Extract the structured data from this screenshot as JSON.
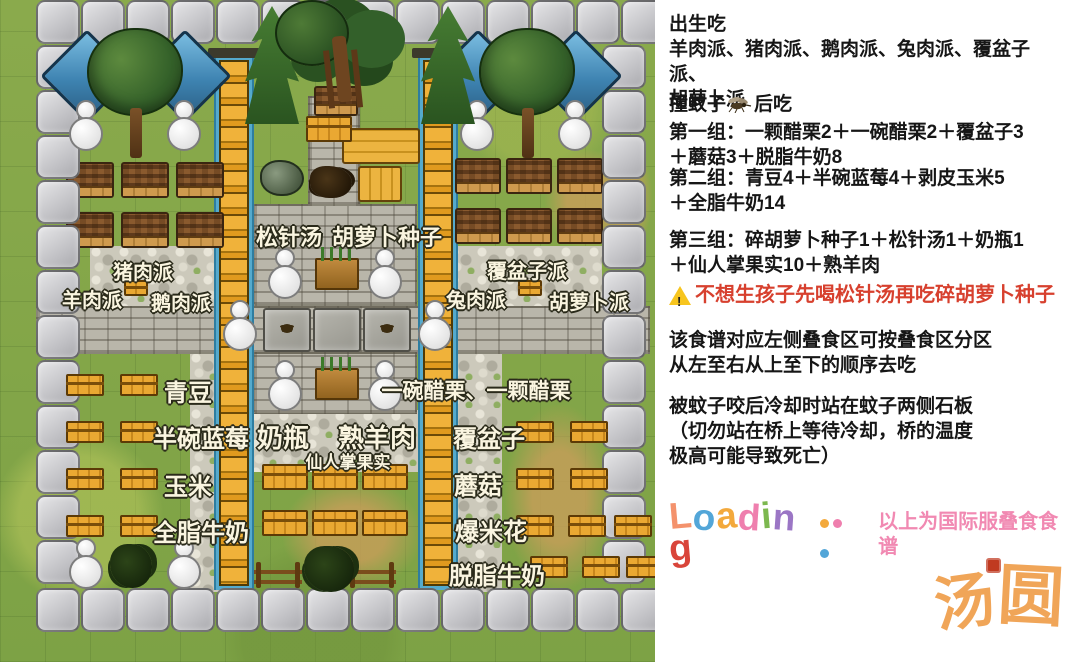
{
  "right_panel": {
    "birth": {
      "title": "出生吃",
      "body": "羊肉派、猪肉派、鹅肉派、兔肉派、覆盆子派、\n胡萝卜派"
    },
    "mosquito": {
      "title_pre": "撞蚊子",
      "title_post": "后吃",
      "group1": "第一组：一颗醋栗2＋一碗醋栗2＋覆盆子3\n＋蘑菇3＋脱脂牛奶8"
    },
    "group2": "第二组：青豆4＋半碗蓝莓4＋剥皮玉米5\n＋全脂牛奶14",
    "group3": "第三组：碎胡萝卜种子1＋松针汤1＋奶瓶1\n＋仙人掌果实10＋熟羊肉",
    "warning": "不想生孩子先喝松针汤再吃碎胡萝卜种子",
    "warning_color": "#d7402e",
    "note1": "该食谱对应左侧叠食区可按叠食区分区\n从左至右从上至下的顺序去吃",
    "note2": "被蚊子咬后冷却时站在蚊子两侧石板\n（切勿站在桥上等待冷却，桥的温度\n极高可能导致死亡）",
    "loading": {
      "letters": [
        {
          "ch": "L",
          "color": "#f4926c"
        },
        {
          "ch": "o",
          "color": "#53a6d8"
        },
        {
          "ch": "a",
          "color": "#f3a93c"
        },
        {
          "ch": "d",
          "color": "#ef7fae"
        },
        {
          "ch": "i",
          "color": "#7cb84f"
        },
        {
          "ch": "n",
          "color": "#9b76c5"
        },
        {
          "ch": "g",
          "color": "#d9453a"
        }
      ],
      "dots": [
        "#f3a93c",
        "#ef7fae",
        "#53a6d8"
      ],
      "caption": "以上为国际服叠食食谱",
      "caption_color": "#f189b2"
    },
    "watermark": {
      "char1": "汤",
      "char2": "圆",
      "color": "#f0a558"
    }
  },
  "map": {
    "labels": [
      {
        "text": "松针汤",
        "x": 289,
        "y": 220,
        "s": 22
      },
      {
        "text": "胡萝卜种子",
        "x": 387,
        "y": 220,
        "s": 22
      },
      {
        "text": "猪肉派",
        "x": 143,
        "y": 256,
        "s": 20
      },
      {
        "text": "羊肉派",
        "x": 92,
        "y": 284,
        "s": 20
      },
      {
        "text": "鹅肉派",
        "x": 181,
        "y": 287,
        "s": 20
      },
      {
        "text": "覆盆子派",
        "x": 527,
        "y": 255,
        "s": 20
      },
      {
        "text": "兔肉派",
        "x": 476,
        "y": 284,
        "s": 20
      },
      {
        "text": "胡萝卜派",
        "x": 589,
        "y": 286,
        "s": 20
      },
      {
        "text": "青豆",
        "x": 188,
        "y": 373,
        "s": 24
      },
      {
        "text": "一碗醋栗、一颗醋栗",
        "x": 476,
        "y": 375,
        "s": 21
      },
      {
        "text": "半碗蓝莓",
        "x": 201,
        "y": 419,
        "s": 24
      },
      {
        "text": "奶瓶",
        "x": 283,
        "y": 418,
        "s": 26
      },
      {
        "text": "熟羊肉",
        "x": 377,
        "y": 418,
        "s": 26
      },
      {
        "text": "覆盆子",
        "x": 489,
        "y": 419,
        "s": 24
      },
      {
        "text": "仙人掌果实",
        "x": 348,
        "y": 448,
        "s": 17
      },
      {
        "text": "玉米",
        "x": 188,
        "y": 467,
        "s": 24
      },
      {
        "text": "蘑菇",
        "x": 478,
        "y": 466,
        "s": 24
      },
      {
        "text": "全脂牛奶",
        "x": 201,
        "y": 513,
        "s": 24
      },
      {
        "text": "爆米花",
        "x": 491,
        "y": 512,
        "s": 24
      },
      {
        "text": "脱脂牛奶",
        "x": 497,
        "y": 556,
        "s": 24
      }
    ],
    "elements": [
      {
        "t": "dirt",
        "x": 545,
        "y": 150,
        "w": 85,
        "h": 100
      },
      {
        "t": "dirt",
        "x": 600,
        "y": 140,
        "w": 52,
        "h": 115
      },
      {
        "t": "dirt",
        "x": 505,
        "y": 405,
        "w": 108,
        "h": 185
      },
      {
        "t": "dirt",
        "x": 283,
        "y": 478,
        "w": 138,
        "h": 112
      },
      {
        "t": "cobble",
        "x": 90,
        "y": 246,
        "w": 162,
        "h": 62
      },
      {
        "t": "cobble",
        "x": 448,
        "y": 246,
        "w": 154,
        "h": 62
      },
      {
        "t": "cobble",
        "x": 190,
        "y": 352,
        "w": 52,
        "h": 240
      },
      {
        "t": "cobble",
        "x": 446,
        "y": 352,
        "w": 56,
        "h": 240
      },
      {
        "t": "cobble",
        "x": 250,
        "y": 410,
        "w": 170,
        "h": 62
      },
      {
        "t": "road",
        "x": 36,
        "y": 306,
        "w": 614,
        "h": 48
      },
      {
        "t": "brick",
        "x": 253,
        "y": 204,
        "w": 164,
        "h": 102
      },
      {
        "t": "brick",
        "x": 253,
        "y": 352,
        "w": 164,
        "h": 62
      },
      {
        "t": "brick",
        "x": 308,
        "y": 96,
        "w": 52,
        "h": 110
      },
      {
        "t": "water",
        "x": 214,
        "y": 56,
        "w": 40,
        "h": 534
      },
      {
        "t": "water",
        "x": 418,
        "y": 56,
        "w": 40,
        "h": 534
      },
      {
        "t": "lintel",
        "x": 208,
        "y": 48,
        "w": 52,
        "h": 10
      },
      {
        "t": "lintel",
        "x": 412,
        "y": 48,
        "w": 52,
        "h": 10
      },
      {
        "t": "ladder",
        "x": 219,
        "y": 60,
        "w": 30,
        "h": 526
      },
      {
        "t": "ladder",
        "x": 423,
        "y": 60,
        "w": 30,
        "h": 526
      },
      {
        "t": "slab",
        "x": 263,
        "y": 308,
        "w": 48,
        "h": 44
      },
      {
        "t": "slab",
        "x": 313,
        "y": 308,
        "w": 48,
        "h": 44
      },
      {
        "t": "slab",
        "x": 363,
        "y": 308,
        "w": 48,
        "h": 44
      },
      {
        "t": "plot",
        "x": 66,
        "y": 162,
        "w": 48,
        "h": 36
      },
      {
        "t": "plot",
        "x": 121,
        "y": 162,
        "w": 48,
        "h": 36
      },
      {
        "t": "plot",
        "x": 176,
        "y": 162,
        "w": 48,
        "h": 36
      },
      {
        "t": "plot",
        "x": 66,
        "y": 212,
        "w": 48,
        "h": 36
      },
      {
        "t": "plot",
        "x": 121,
        "y": 212,
        "w": 48,
        "h": 36
      },
      {
        "t": "plot",
        "x": 176,
        "y": 212,
        "w": 48,
        "h": 36
      },
      {
        "t": "plot",
        "x": 455,
        "y": 158,
        "w": 46,
        "h": 36
      },
      {
        "t": "plot",
        "x": 506,
        "y": 158,
        "w": 46,
        "h": 36
      },
      {
        "t": "plot",
        "x": 557,
        "y": 158,
        "w": 46,
        "h": 36
      },
      {
        "t": "plot",
        "x": 455,
        "y": 208,
        "w": 46,
        "h": 36
      },
      {
        "t": "plot",
        "x": 506,
        "y": 208,
        "w": 46,
        "h": 36
      },
      {
        "t": "plot",
        "x": 557,
        "y": 208,
        "w": 46,
        "h": 36
      },
      {
        "t": "plot",
        "x": 314,
        "y": 86,
        "w": 44,
        "h": 30
      },
      {
        "t": "tileRow",
        "x": 36,
        "y": 0,
        "n": 14
      },
      {
        "t": "tileCol",
        "x": 36,
        "y": 45,
        "n": 12
      },
      {
        "t": "tileCol",
        "x": 602,
        "y": 45,
        "n": 12
      },
      {
        "t": "tileRow",
        "x": 36,
        "y": 588,
        "n": 14
      },
      {
        "t": "diamond",
        "x": 54,
        "y": 43
      },
      {
        "t": "diamond",
        "x": 152,
        "y": 43
      },
      {
        "t": "diamond",
        "x": 445,
        "y": 43
      },
      {
        "t": "diamond",
        "x": 543,
        "y": 43
      },
      {
        "t": "signH",
        "x": 342,
        "y": 128,
        "w": 78,
        "h": 36
      },
      {
        "t": "signV",
        "x": 358,
        "y": 166,
        "w": 44,
        "h": 36
      },
      {
        "t": "rock",
        "x": 260,
        "y": 160,
        "w": 44,
        "h": 36
      },
      {
        "t": "twigs",
        "x": 310,
        "y": 166,
        "w": 42,
        "h": 32
      },
      {
        "t": "crate",
        "x": 306,
        "y": 116,
        "w": 46,
        "h": 26
      },
      {
        "t": "crate",
        "x": 66,
        "y": 374,
        "w": 38,
        "h": 22
      },
      {
        "t": "crate",
        "x": 120,
        "y": 374,
        "w": 38,
        "h": 22
      },
      {
        "t": "crate",
        "x": 66,
        "y": 421,
        "w": 38,
        "h": 22
      },
      {
        "t": "crate",
        "x": 120,
        "y": 421,
        "w": 38,
        "h": 22
      },
      {
        "t": "crate",
        "x": 66,
        "y": 468,
        "w": 38,
        "h": 22
      },
      {
        "t": "crate",
        "x": 120,
        "y": 468,
        "w": 38,
        "h": 22
      },
      {
        "t": "crate",
        "x": 66,
        "y": 515,
        "w": 38,
        "h": 22
      },
      {
        "t": "crate",
        "x": 120,
        "y": 515,
        "w": 38,
        "h": 22
      },
      {
        "t": "crate",
        "x": 516,
        "y": 421,
        "w": 38,
        "h": 22
      },
      {
        "t": "crate",
        "x": 570,
        "y": 421,
        "w": 38,
        "h": 22
      },
      {
        "t": "crate",
        "x": 516,
        "y": 468,
        "w": 38,
        "h": 22
      },
      {
        "t": "crate",
        "x": 570,
        "y": 468,
        "w": 38,
        "h": 22
      },
      {
        "t": "crate",
        "x": 516,
        "y": 515,
        "w": 38,
        "h": 22
      },
      {
        "t": "crate",
        "x": 568,
        "y": 515,
        "w": 38,
        "h": 22
      },
      {
        "t": "crate",
        "x": 614,
        "y": 515,
        "w": 38,
        "h": 22
      },
      {
        "t": "crate",
        "x": 530,
        "y": 556,
        "w": 38,
        "h": 22
      },
      {
        "t": "crate",
        "x": 582,
        "y": 556,
        "w": 38,
        "h": 22
      },
      {
        "t": "crate",
        "x": 626,
        "y": 556,
        "w": 38,
        "h": 22
      },
      {
        "t": "crateBig",
        "x": 262,
        "y": 464,
        "w": 46,
        "h": 26
      },
      {
        "t": "crateBig",
        "x": 312,
        "y": 464,
        "w": 46,
        "h": 26
      },
      {
        "t": "crateBig",
        "x": 362,
        "y": 464,
        "w": 46,
        "h": 26
      },
      {
        "t": "crateBig",
        "x": 262,
        "y": 510,
        "w": 46,
        "h": 26
      },
      {
        "t": "crateBig",
        "x": 312,
        "y": 510,
        "w": 46,
        "h": 26
      },
      {
        "t": "crateBig",
        "x": 362,
        "y": 510,
        "w": 46,
        "h": 26
      },
      {
        "t": "crateTiny",
        "x": 124,
        "y": 280,
        "w": 24,
        "h": 16
      },
      {
        "t": "crateTiny",
        "x": 518,
        "y": 280,
        "w": 24,
        "h": 16
      },
      {
        "t": "planter",
        "x": 315,
        "y": 258,
        "w": 44,
        "h": 32
      },
      {
        "t": "planter",
        "x": 315,
        "y": 368,
        "w": 44,
        "h": 32
      },
      {
        "t": "fence",
        "x": 254,
        "y": 564,
        "w": 48,
        "h": 24
      },
      {
        "t": "fence",
        "x": 348,
        "y": 564,
        "w": 48,
        "h": 24
      },
      {
        "t": "bush",
        "x": 110,
        "y": 544,
        "w": 42,
        "h": 44
      },
      {
        "t": "bush",
        "x": 304,
        "y": 546,
        "w": 50,
        "h": 46
      },
      {
        "t": "snowman",
        "x": 69,
        "y": 100
      },
      {
        "t": "snowman",
        "x": 167,
        "y": 100
      },
      {
        "t": "snowman",
        "x": 460,
        "y": 100
      },
      {
        "t": "snowman",
        "x": 558,
        "y": 100
      },
      {
        "t": "snowman",
        "x": 268,
        "y": 248
      },
      {
        "t": "snowman",
        "x": 368,
        "y": 248
      },
      {
        "t": "snowman",
        "x": 223,
        "y": 300
      },
      {
        "t": "snowman",
        "x": 418,
        "y": 300
      },
      {
        "t": "snowman",
        "x": 268,
        "y": 360
      },
      {
        "t": "snowman",
        "x": 368,
        "y": 360
      },
      {
        "t": "snowman",
        "x": 69,
        "y": 538
      },
      {
        "t": "snowman",
        "x": 167,
        "y": 538
      },
      {
        "t": "treeRound",
        "x": 87,
        "y": 28
      },
      {
        "t": "treeRound",
        "x": 479,
        "y": 28
      },
      {
        "t": "pine",
        "x": 245,
        "y": 6
      },
      {
        "t": "pine",
        "x": 421,
        "y": 6
      },
      {
        "t": "bigTree",
        "x": 267,
        "y": 0
      },
      {
        "t": "mosquito",
        "x": 281,
        "y": 324
      },
      {
        "t": "mosquito",
        "x": 381,
        "y": 324
      }
    ]
  }
}
